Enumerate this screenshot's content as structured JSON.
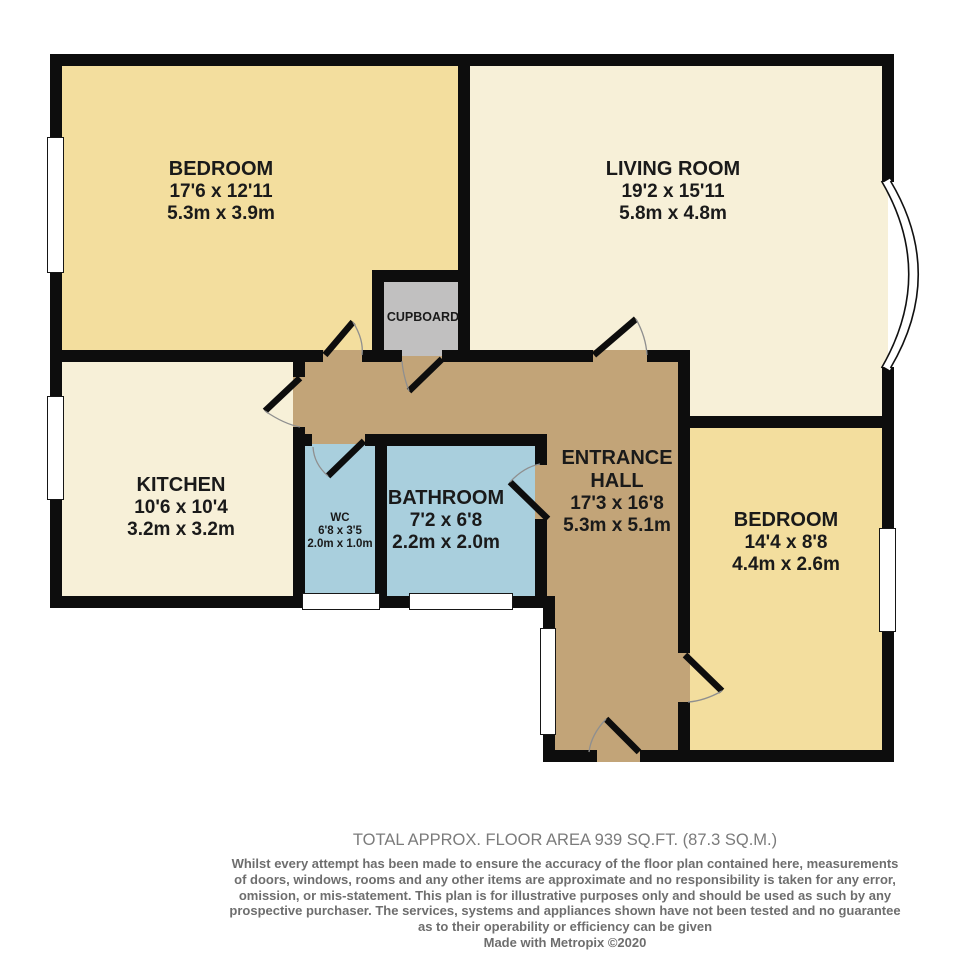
{
  "colors": {
    "wall": "#0d0d0d",
    "yellow": "#f3de9e",
    "cream": "#f7f0d8",
    "tan": "#c2a478",
    "blue": "#a9cfdd",
    "gray": "#c1c0c0",
    "label_text": "#1a1a1a",
    "footer_title": "#7b7b7b",
    "footer_text": "#6e6e6e"
  },
  "rooms": {
    "bedroom1": {
      "name": "BEDROOM",
      "imperial": "17'6 x 12'11",
      "metric": "5.3m x 3.9m"
    },
    "living": {
      "name": "LIVING ROOM",
      "imperial": "19'2 x 15'11",
      "metric": "5.8m x 4.8m"
    },
    "kitchen": {
      "name": "KITCHEN",
      "imperial": "10'6 x 10'4",
      "metric": "3.2m x 3.2m"
    },
    "wc": {
      "name": "WC",
      "imperial": "6'8 x 3'5",
      "metric": "2.0m x 1.0m"
    },
    "bathroom": {
      "name": "BATHROOM",
      "imperial": "7'2 x 6'8",
      "metric": "2.2m x 2.0m"
    },
    "hall": {
      "name": "ENTRANCE HALL",
      "imperial": "17'3 x 16'8",
      "metric": "5.3m x 5.1m"
    },
    "bedroom2": {
      "name": "BEDROOM",
      "imperial": "14'4 x 8'8",
      "metric": "4.4m x 2.6m"
    },
    "cupboard": {
      "name": "CUPBOARD"
    }
  },
  "footer": {
    "total_area": "TOTAL APPROX. FLOOR AREA 939 SQ.FT. (87.3 SQ.M.)",
    "disclaimer_lines": [
      "Whilst every attempt has been made to ensure the accuracy of the floor plan contained here, measurements",
      "of doors, windows, rooms and any other items are approximate and no responsibility is taken for any error,",
      "omission, or mis-statement. This plan is for illustrative purposes only and should be used as such by any",
      "prospective purchaser. The services, systems and appliances shown have not been tested and no guarantee",
      "as to their operability or efficiency can be given"
    ],
    "credit": "Made with Metropix ©2020"
  }
}
